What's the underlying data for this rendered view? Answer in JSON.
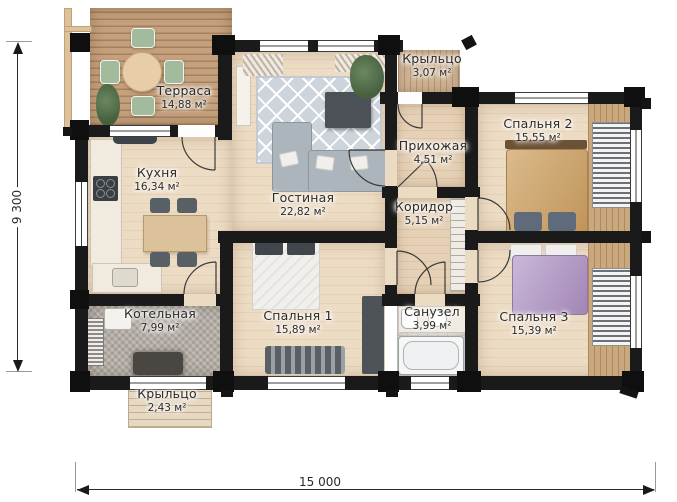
{
  "plan_type": "floor-plan",
  "rooms": [
    {
      "id": "terrace",
      "name": "Терраса",
      "area": "14,88 м²"
    },
    {
      "id": "kitchen",
      "name": "Кухня",
      "area": "16,34 м²"
    },
    {
      "id": "living",
      "name": "Гостиная",
      "area": "22,82 м²"
    },
    {
      "id": "porch-top",
      "name": "Крыльцо",
      "area": "3,07 м²"
    },
    {
      "id": "hallway",
      "name": "Прихожая",
      "area": "4,51 м²"
    },
    {
      "id": "corridor",
      "name": "Коридор",
      "area": "5,15 м²"
    },
    {
      "id": "bedroom-2",
      "name": "Спальня 2",
      "area": "15,55 м²"
    },
    {
      "id": "bedroom-1",
      "name": "Спальня 1",
      "area": "15,89 м²"
    },
    {
      "id": "bathroom",
      "name": "Санузел",
      "area": "3,99 м²"
    },
    {
      "id": "bedroom-3",
      "name": "Спальня 3",
      "area": "15,39 м²"
    },
    {
      "id": "boiler-room",
      "name": "Котельная",
      "area": "7,99 м²"
    },
    {
      "id": "porch-bottom",
      "name": "Крыльцо",
      "area": "2,43 м²"
    }
  ],
  "dimensions": {
    "overall_width_mm": "15 000",
    "overall_depth_mm": "9 300"
  },
  "colors": {
    "wall": "#1a1a1a",
    "floor_wood": "#eddcc4",
    "terrace_deck": "#c4a07c",
    "rug": "#cdd4db",
    "bed2_accent": "#cfa366",
    "bed3_accent": "#b399c7"
  }
}
